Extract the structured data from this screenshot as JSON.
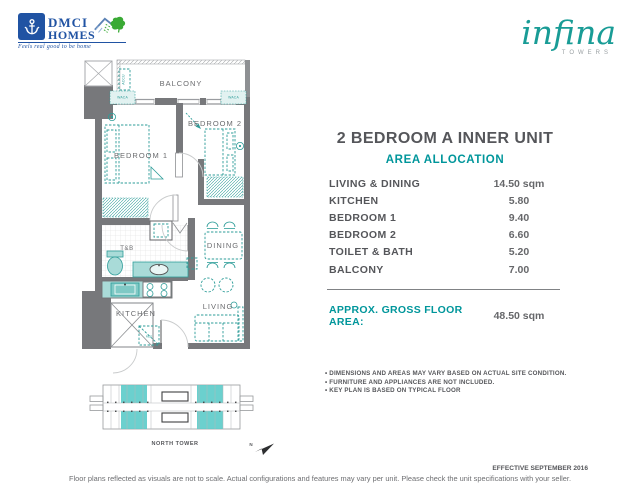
{
  "branding": {
    "dmci": {
      "line1": "DMCI",
      "line2": "HOMES",
      "tagline": "Feels real good to be home",
      "blue": "#2053A3",
      "green": "#3AAA35"
    },
    "infina": {
      "name": "infina",
      "sub": "TOWERS",
      "teal": "#199C96"
    }
  },
  "unit": {
    "title": "2 BEDROOM A INNER UNIT",
    "section": "AREA ALLOCATION",
    "areas": [
      {
        "label": "LIVING & DINING",
        "value": "14.50 sqm"
      },
      {
        "label": "KITCHEN",
        "value": "5.80"
      },
      {
        "label": "BEDROOM 1",
        "value": "9.40"
      },
      {
        "label": "BEDROOM 2",
        "value": "6.60"
      },
      {
        "label": "TOILET & BATH",
        "value": "5.20"
      },
      {
        "label": "BALCONY",
        "value": "7.00"
      }
    ],
    "gross": {
      "label": "APPROX. GROSS FLOOR AREA:",
      "value": "48.50 sqm"
    },
    "notes": [
      "DIMENSIONS AND AREAS MAY VARY BASED ON ACTUAL SITE CONDITION.",
      "FURNITURE AND APPLIANCES ARE NOT INCLUDED.",
      "KEY PLAN IS BASED ON TYPICAL FLOOR"
    ]
  },
  "floorplan": {
    "rooms": {
      "balcony": "BALCONY",
      "bedroom1": "BEDROOM 1",
      "bedroom2": "BEDROOM 2",
      "tb": "T&B",
      "dining": "DINING",
      "kitchen": "KITCHEN",
      "living": "LIVING"
    },
    "small": {
      "accu": "ACCU",
      "waca": "WACA",
      "ref": "REF"
    },
    "colors": {
      "wall": "#77787B",
      "furniture": "#2E9D99",
      "fixture_fill": "#A9DBD8"
    }
  },
  "keyplan": {
    "label": "NORTH TOWER",
    "north": "N",
    "highlight": "#5BCBC9"
  },
  "page": {
    "effective": "EFFECTIVE SEPTEMBER 2016",
    "footer": "Floor plans reflected as visuals are not to scale. Actual configurations and features may vary per unit. Please check the unit specifications with your seller."
  }
}
